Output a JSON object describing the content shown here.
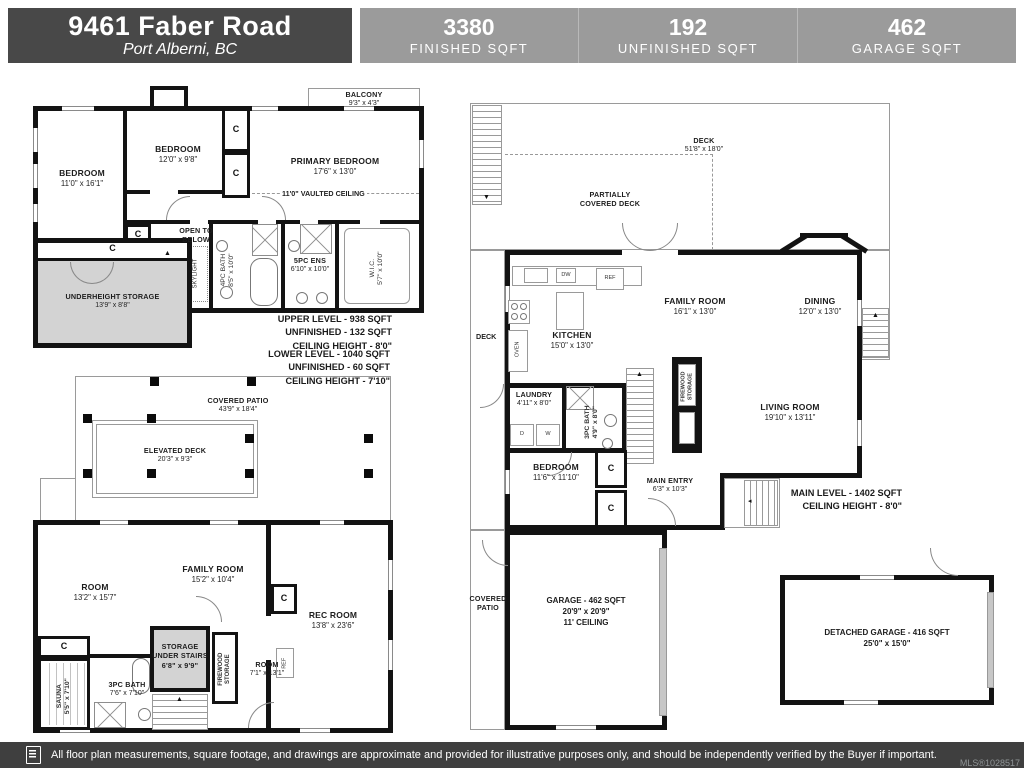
{
  "header": {
    "title": "9461 Faber Road",
    "subtitle": "Port Alberni, BC",
    "stats": [
      {
        "value": "3380",
        "label": "FINISHED SQFT"
      },
      {
        "value": "192",
        "label": "UNFINISHED SQFT"
      },
      {
        "value": "462",
        "label": "GARAGE SQFT"
      }
    ]
  },
  "plans": {
    "upper": {
      "balcony_name": "BALCONY",
      "balcony_dims": "9'3\" x 4'3\"",
      "bedroom1_name": "BEDROOM",
      "bedroom1_dims": "11'0\" x 16'1\"",
      "bedroom2_name": "BEDROOM",
      "bedroom2_dims": "12'0\" x 9'8\"",
      "primary_name": "PRIMARY BEDROOM",
      "primary_dims": "17'6\" x 13'0\"",
      "vaulted_note": "11'0\" VAULTED CEILING",
      "open_to_below": "OPEN TO\nBELOW",
      "skylight": "SKYLIGHT",
      "bath_label": "4PC BATH\n8'5\" x 10'0\"",
      "ens_name": "5PC ENS",
      "ens_dims": "6'10\" x 10'0\"",
      "wic_label": "W.I.C.\n5'7\" x 10'0\"",
      "storage_name": "UNDERHEIGHT STORAGE",
      "storage_dims": "13'9\" x 8'8\"",
      "closet": "C",
      "notes": "UPPER LEVEL - 938 SQFT\nUNFINISHED - 132 SQFT\nCEILING HEIGHT - 8'0\""
    },
    "lower": {
      "notes": "LOWER LEVEL - 1040 SQFT\nUNFINISHED - 60 SQFT\nCEILING HEIGHT - 7'10\"",
      "patio_name": "COVERED PATIO",
      "patio_dims": "43'9\" x 18'4\"",
      "deck_name": "ELEVATED DECK",
      "deck_dims": "20'3\" x 9'3\"",
      "room1_name": "ROOM",
      "room1_dims": "13'2\" x 15'7\"",
      "family_name": "FAMILY ROOM",
      "family_dims": "15'2\" x 10'4\"",
      "rec_name": "REC ROOM",
      "rec_dims": "13'8\" x 23'6\"",
      "sauna_label": "SAUNA\n5'5\" x 7'10\"",
      "bath_name": "3PC BATH",
      "bath_dims": "7'6\" x 7'10\"",
      "storage_stairs": "STORAGE\nUNDER STAIRS\n6'8\" x 9'9\"",
      "firewood": "FIREWOOD\nSTORAGE",
      "room2_name": "ROOM",
      "room2_dims": "7'1\" x 13'1\"",
      "ref": "REF",
      "closet": "C"
    },
    "main": {
      "deck_name": "DECK",
      "deck_dims": "51'8\" x 18'0\"",
      "partially": "PARTIALLY\nCOVERED DECK",
      "deck_side": "DECK",
      "kitchen_name": "KITCHEN",
      "kitchen_dims": "15'0\" x 13'0\"",
      "family_name": "FAMILY ROOM",
      "family_dims": "16'1\" x 13'0\"",
      "dining_name": "DINING",
      "dining_dims": "12'0\" x 13'0\"",
      "laundry_name": "LAUNDRY",
      "laundry_dims": "4'11\" x 8'0\"",
      "bath_label": "3PC BATH\n4'9\" x 8'0\"",
      "firewood": "FIREWOOD\nSTORAGE",
      "living_name": "LIVING ROOM",
      "living_dims": "19'10\" x 13'11\"",
      "bedroom_name": "BEDROOM",
      "bedroom_dims": "11'6\" x 11'10\"",
      "entry_name": "MAIN ENTRY",
      "entry_dims": "6'3\" x 10'3\"",
      "closet": "C",
      "notes": "MAIN LEVEL - 1402 SQFT\nCEILING HEIGHT - 8'0\"",
      "patio": "COVERED\nPATIO",
      "garage": "GARAGE - 462 SQFT\n20'9\" x 20'9\"\n11' CEILING",
      "detached": "DETACHED GARAGE - 416 SQFT\n25'0\" x 15'0\"",
      "oven": "OVEN",
      "dw": "DW",
      "ref": "REF",
      "d": "D",
      "w": "W"
    }
  },
  "footer": {
    "disclaimer": "All floor plan measurements, square footage, and drawings are approximate and provided for illustrative purposes only, and should be independently verified by the Buyer if important.",
    "mls": "MLS®1028517"
  }
}
